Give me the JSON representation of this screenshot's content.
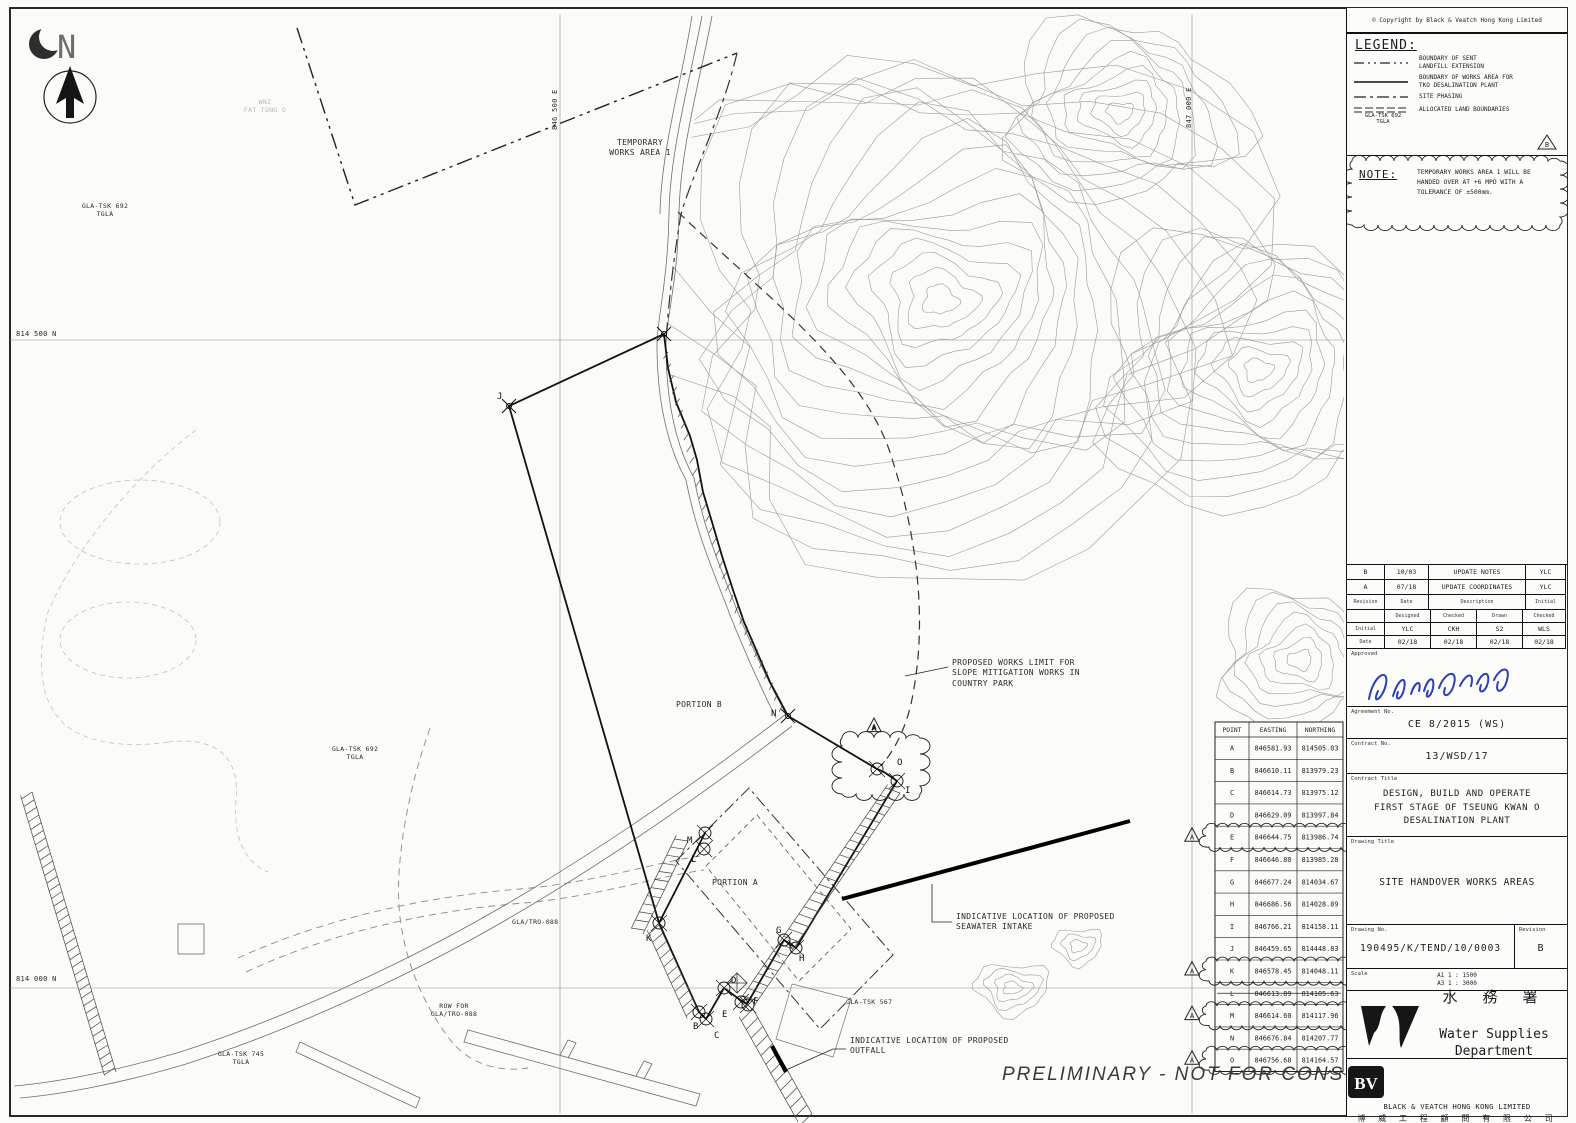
{
  "copyright": "© Copyright by Black & Veatch Hong Kong Limited",
  "north_letter": "N",
  "legend": {
    "title": "LEGEND:",
    "items": [
      {
        "label": "BOUNDARY OF SENT\nLANDFILL EXTENSION"
      },
      {
        "label": "BOUNDARY OF WORKS AREA FOR\nTKO DESALINATION PLANT"
      },
      {
        "label": "SITE PHASING"
      },
      {
        "label": "ALLOCATED LAND BOUNDARIES"
      }
    ],
    "alloc_tag": "GLA-TSK 692\nTGLA",
    "triangle_letter": "B"
  },
  "note": {
    "title": "NOTE:",
    "text": "TEMPORARY WORKS AREA 1 WILL BE\nHANDED OVER AT +6 MPD WITH A\nTOLERANCE OF ±500mm."
  },
  "revisions": {
    "entries": [
      {
        "rev": "B",
        "date": "10/03",
        "description": "UPDATE NOTES",
        "initial": "YLC"
      },
      {
        "rev": "A",
        "date": "07/18",
        "description": "UPDATE COORDINATES",
        "initial": "YLC"
      }
    ],
    "col_headers": {
      "rev": "Revision",
      "date": "Date",
      "description": "Description",
      "initial": "Initial"
    },
    "role_headers": [
      "Designed",
      "Checked",
      "Drawn",
      "Checked"
    ],
    "initial_label": "Initial",
    "initials": [
      "YLC",
      "CKH",
      "S2",
      "WLS"
    ],
    "date_label": "Date",
    "dates": [
      "02/18",
      "02/18",
      "02/18",
      "02/18"
    ],
    "approved_label": "Approved"
  },
  "title_block": {
    "agreement_label": "Agreement No.",
    "agreement": "CE 8/2015 (WS)",
    "contract_no_label": "Contract No.",
    "contract_no": "13/WSD/17",
    "contract_title_label": "Contract Title",
    "contract_title": "DESIGN, BUILD AND OPERATE\nFIRST STAGE OF TSEUNG KWAN O\nDESALINATION PLANT",
    "drawing_title_label": "Drawing Title",
    "drawing_title": "SITE HANDOVER WORKS AREAS",
    "drawing_no_label": "Drawing No.",
    "drawing_no": "190495/K/TEND/10/0003",
    "revision_label": "Revision",
    "revision": "B",
    "scale_label": "Scale",
    "scale": "A1 1 : 1500\nA3 1 : 3000",
    "wsd_chinese": "水 務 署",
    "wsd_name": "Water Supplies\nDepartment",
    "bv_logo": "BV",
    "bv_name": "BLACK & VEATCH HONG KONG LIMITED",
    "bv_chinese": "博 威 工 程 顧 問 有 限 公 司"
  },
  "map": {
    "grid": {
      "n1": "814 500 N",
      "n2": "814 000 N",
      "e1": "846 500 E",
      "e2": "847 000 E"
    },
    "labels": {
      "temp_works": "TEMPORARY\nWORKS AREA 1",
      "gla692_a": "GLA-TSK 692\nTGLA",
      "gla692_b": "GLA-TSK 692\nTGLA",
      "fat_tong": "WNZ\nFAT TONG O",
      "portion_a": "PORTION A",
      "portion_b": "PORTION B",
      "works_limit": "PROPOSED WORKS LIMIT FOR\nSLOPE MITIGATION WORKS IN\nCOUNTRY PARK",
      "intake": "INDICATIVE LOCATION OF PROPOSED\nSEAWATER INTAKE",
      "outfall": "INDICATIVE LOCATION OF PROPOSED\nOUTFALL",
      "gla_tro": "GLA/TRO-088",
      "row_for": "ROW FOR\nGLA/TRO-088",
      "gla567": "GLA-TSK 567",
      "gla745": "GLA-TSK 745\nTGLA",
      "preliminary": "PRELIMINARY  -  NOT FOR CONSTRUCTION"
    },
    "point_letters": [
      "J",
      "K",
      "M",
      "L",
      "B",
      "C",
      "D",
      "E",
      "F",
      "G",
      "H",
      "I",
      "N",
      "O"
    ],
    "coord_table": {
      "headers": [
        "POINT",
        "EASTING",
        "NORTHING"
      ],
      "rows": [
        {
          "p": "A",
          "e": "846581.93",
          "n": "814505.03"
        },
        {
          "p": "B",
          "e": "846610.11",
          "n": "813979.23"
        },
        {
          "p": "C",
          "e": "846614.73",
          "n": "813975.12"
        },
        {
          "p": "D",
          "e": "846629.09",
          "n": "813997.84"
        },
        {
          "p": "E",
          "e": "846644.75",
          "n": "813986.74",
          "cloud": true
        },
        {
          "p": "F",
          "e": "846646.80",
          "n": "813985.28"
        },
        {
          "p": "G",
          "e": "846677.24",
          "n": "814034.67"
        },
        {
          "p": "H",
          "e": "846686.56",
          "n": "814028.89"
        },
        {
          "p": "I",
          "e": "846766.21",
          "n": "814158.11"
        },
        {
          "p": "J",
          "e": "846459.65",
          "n": "814448.83"
        },
        {
          "p": "K",
          "e": "846578.45",
          "n": "814048.11",
          "cloud": true
        },
        {
          "p": "L",
          "e": "846613.89",
          "n": "814105.63",
          "struck": true
        },
        {
          "p": "M",
          "e": "846614.60",
          "n": "814117.96",
          "cloud": true
        },
        {
          "p": "N",
          "e": "846676.84",
          "n": "814207.77"
        },
        {
          "p": "O",
          "e": "846756.68",
          "n": "814164.57",
          "cloud": true
        }
      ],
      "triangle_letter": "A"
    },
    "map_cloud_letter": "A"
  },
  "colors": {
    "line": "#1c1c1c",
    "contour": "#9b9b9b",
    "signature": "#2b3fbb"
  }
}
